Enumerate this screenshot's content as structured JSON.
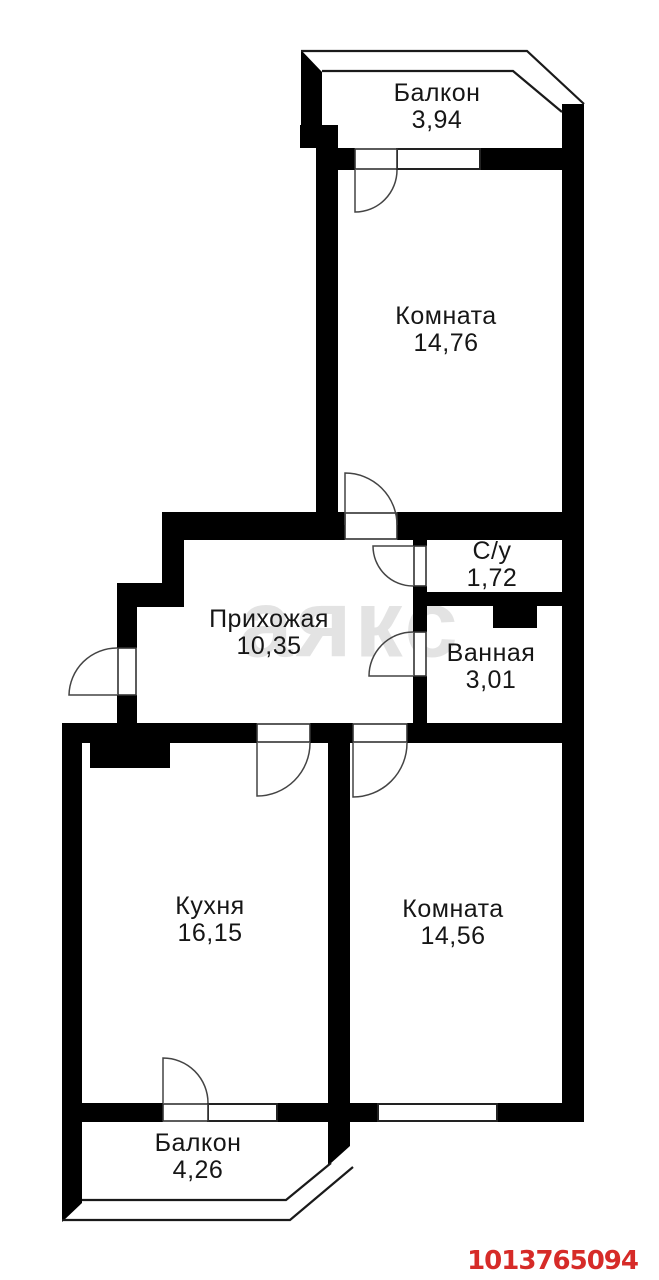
{
  "plan": {
    "rooms": [
      {
        "id": "balcony-top",
        "name": "Балкон",
        "area": "3,94"
      },
      {
        "id": "room-top",
        "name": "Комната",
        "area": "14,76"
      },
      {
        "id": "wc",
        "name": "С/у",
        "area": "1,72"
      },
      {
        "id": "hallway",
        "name": "Прихожая",
        "area": "10,35"
      },
      {
        "id": "bathroom",
        "name": "Ванная",
        "area": "3,01"
      },
      {
        "id": "kitchen",
        "name": "Кухня",
        "area": "16,15"
      },
      {
        "id": "room-bottom",
        "name": "Комната",
        "area": "14,56"
      },
      {
        "id": "balcony-bottom",
        "name": "Балкон",
        "area": "4,26"
      }
    ],
    "watermark": "аякс",
    "listing_id": "1013765094",
    "colors": {
      "wall": "#000000",
      "listing_id": "#d62b28",
      "background": "#ffffff"
    }
  }
}
